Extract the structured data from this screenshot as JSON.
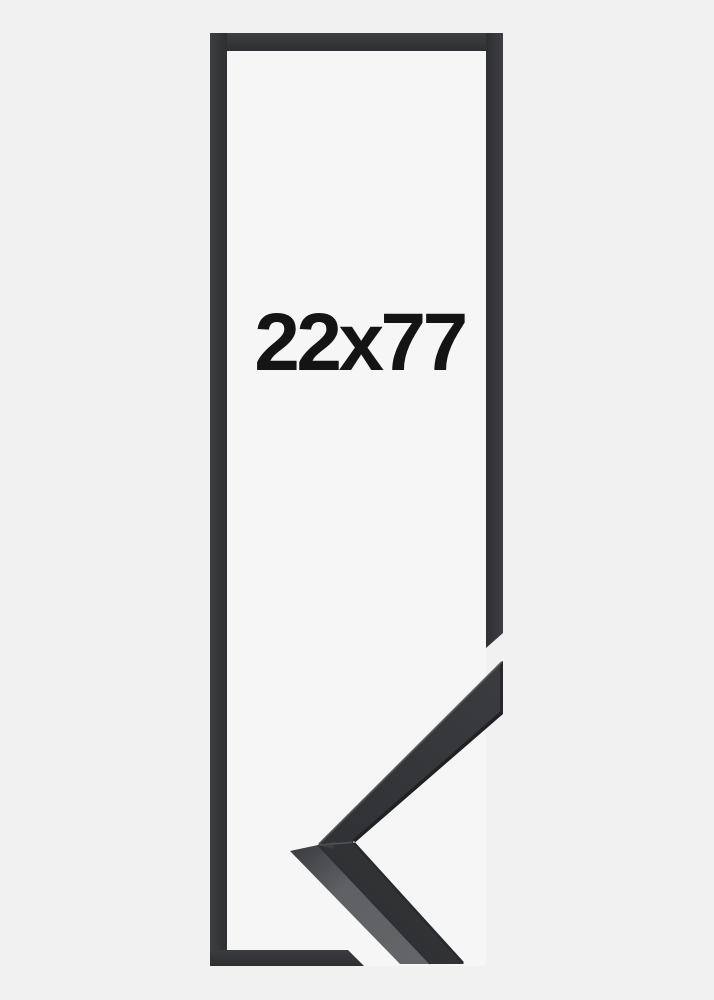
{
  "frame": {
    "size_label": "22x77"
  },
  "colors": {
    "background": "#f1f1f2",
    "frame_interior": "#f6f6f7",
    "frame_moulding": "#323437",
    "label_text": "#141414",
    "sample_face": "#333539",
    "sample_side": "#606265",
    "sample_edge_dark": "#1f2124",
    "sample_highlight": "#505255"
  }
}
